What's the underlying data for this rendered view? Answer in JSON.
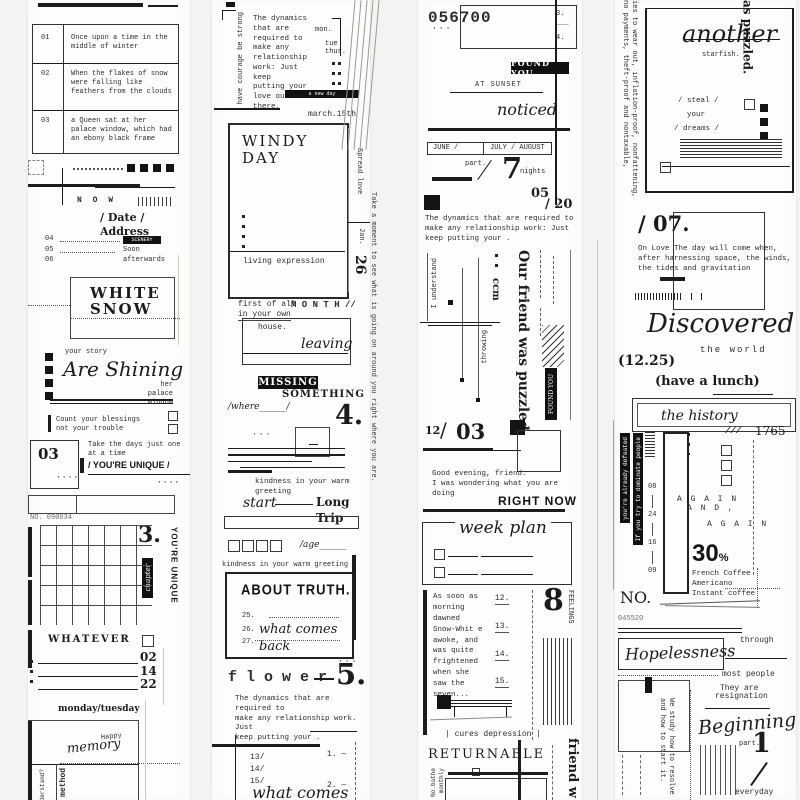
{
  "s1": {
    "rows": [
      {
        "n": "01",
        "t": "Once upon a time in the middle of winter"
      },
      {
        "n": "02",
        "t": "When the flakes of snow were falling like feathers from the clouds"
      },
      {
        "n": "03",
        "t": "a Queen sat at her palace window, which had an ebony black frame"
      }
    ],
    "now": "N O W",
    "date_address": "/ Date / Address",
    "r4": "04",
    "r4l": "SCENERY",
    "r5": "05",
    "r5l": "Soon",
    "r6": "06",
    "r6l": "afterwards",
    "white": "WHITE",
    "snow": "SNOW",
    "your_story": "your story",
    "shining": "Are Shining",
    "palace": "her palace\nwindow",
    "count": "Count your blessings\nnot your trouble",
    "n03": "03",
    "dots": "····",
    "take": "Take the days just one\nat a time",
    "unique": "/ YOU'RE UNIQUE /",
    "no": "NO. 090034",
    "n3": "3.",
    "chapter": "chapter",
    "unique_v": "YOU'RE UNIQUE",
    "whatever": "WHATEVER",
    "v02": "02",
    "v14": "14",
    "v22": "22",
    "days": "monday/tuesday",
    "happy": "Happy",
    "memory": "memory",
    "method": "method",
    "understand": "Understand?"
  },
  "s2": {
    "courage": "have courage be strong",
    "dyn": "The dynamics\nthat are\nrequired to\nmake any\nrelationship\nwork: Just keep\nputting your\nlove out there.",
    "mon": "mon.",
    "tue": "tue",
    "thur": "thur.",
    "bar": "a new day",
    "march": "march.15th",
    "windy": "WINDY\nDAY",
    "living": "living expression",
    "spread": "Spread love",
    "jan": "Jan.",
    "n26": "26",
    "first": "first of all",
    "inyour": "in your own",
    "house": "house.",
    "month": "M O N T H //",
    "leaving": "leaving",
    "missing": "MISSING",
    "something": "SOMETHING",
    "where": "/where______/",
    "n4": "4.",
    "kind": "kindness in your warm\ngreeting",
    "start": "start",
    "trip": "Long Trip",
    "age": "/age______",
    "kind2": "kindness in your warm greeting",
    "truth": "ABOUT TRUTH.",
    "t25": "25.",
    "t26": "26.",
    "t27": "27.",
    "back": "what comes back",
    "flower": "f l o w e r",
    "n5": "5.",
    "dyn2": "The dynamics that are required to\nmake any relationship work. Just\nkeep putting your .",
    "n13": "13/",
    "n14": "14/",
    "n15": "15/",
    "b1": "1. —",
    "b2": "2. —",
    "back2": "what comes back",
    "moment": "Take a moment to see what is going on around you right where you are."
  },
  "s3": {
    "code": "056700",
    "k3": "3. ___",
    "k4": "4. ___",
    "found": "FOUND YOU",
    "sunset": "AT SUNSET",
    "noticed": "noticed",
    "jun": "JUNE  /",
    "jul": "JULY / AUGUST",
    "part": "part.",
    "n7": "7",
    "nights": "nights",
    "d05": "05",
    "d20": "/ 20",
    "dyn": "The dynamics that are required to\nmake any relationship work: Just\nkeep putting your .",
    "understand": "I understand",
    "ccm": "ccm",
    "throwing": "throwing",
    "friend": "Our friend was puzzled.",
    "found_v": "FOUND YOU",
    "d12": "12",
    "slash": "/",
    "d03": "03",
    "evening": "Good evening, friend.\nI was wondering what you are doing",
    "rightnow": "RIGHT NOW",
    "week": "week plan",
    "snowwhite": "As soon as morning dawned Snow-Whit e awoke, and was quite frightened when she saw the seven...",
    "w12": "12.",
    "w13": "13.",
    "w14": "14.",
    "w15": "15.",
    "n8": "8",
    "feelings": "FEELINGS",
    "cures": "|  cures depression  |",
    "returnable": "RETURNABLE",
    "bathe": "No.bathe",
    "monthly": "monthly",
    "friend2": "Our friend w"
  },
  "s5": {
    "wear": "ies to wear out, inflation-proof, nonfattening, no payments, theft-proof and nontaxable,",
    "puzzled": "as puzzled.",
    "another": "another",
    "starfish": "starfish.",
    "steal": "/ steal /",
    "your": "your",
    "dreams": "/ dreams /",
    "n07": "/ 07.",
    "love": "On Love The day will come when,\nafter harnessing space, the winds,\nthe tides and gravitation",
    "discovered": "Discovered",
    "world": "the world",
    "d1225": "(12.25)",
    "lunch": "(have a lunch)",
    "history": "the history",
    "sl": "///",
    "y1765": "1765",
    "defeated": "you're already defeated",
    "dominate": "If you try to dominate people",
    "c08": "08",
    "c24": "24",
    "c16": "16",
    "c09": "09",
    "again1": "A G A I N",
    "again2": "A N D ,",
    "again3": "A G A I N",
    "n30": "30",
    "pct": "%",
    "coffee": "French Coffee\nAmericano\nInstant coffee",
    "no": "NO.",
    "code": "045520",
    "hope": "Hopelessness",
    "through": "through",
    "most": "most people",
    "they": "They are",
    "resig": "resignation",
    "study": "We study how to resolve\nand how to start it.",
    "begin": "Beginning",
    "part": "part.",
    "n1": "1",
    "everyday": "everyday"
  }
}
